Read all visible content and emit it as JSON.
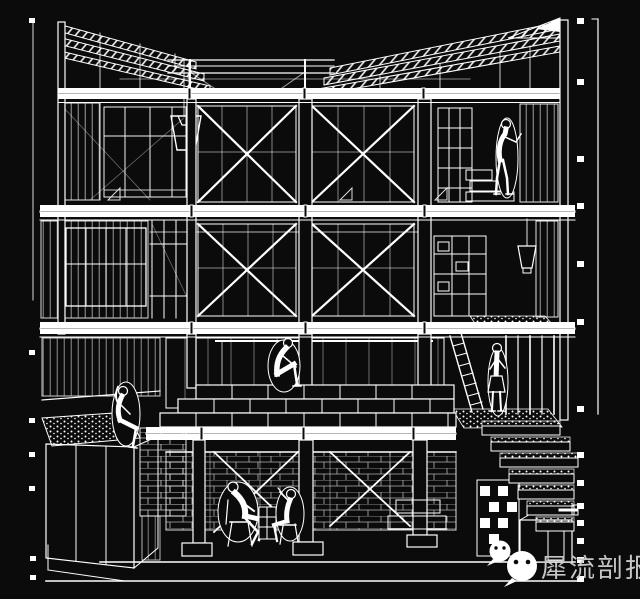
{
  "colors": {
    "bg": "#0b0b0b",
    "line": "#ffffff",
    "watermark": "#c6c6c6"
  },
  "watermark": {
    "text": "犀流剖报",
    "icons": [
      "wechat-icon-large",
      "wechat-icon-small"
    ]
  },
  "drawing": {
    "kind": "architectural-section-perspective",
    "ink": "white-on-black wireframe"
  }
}
